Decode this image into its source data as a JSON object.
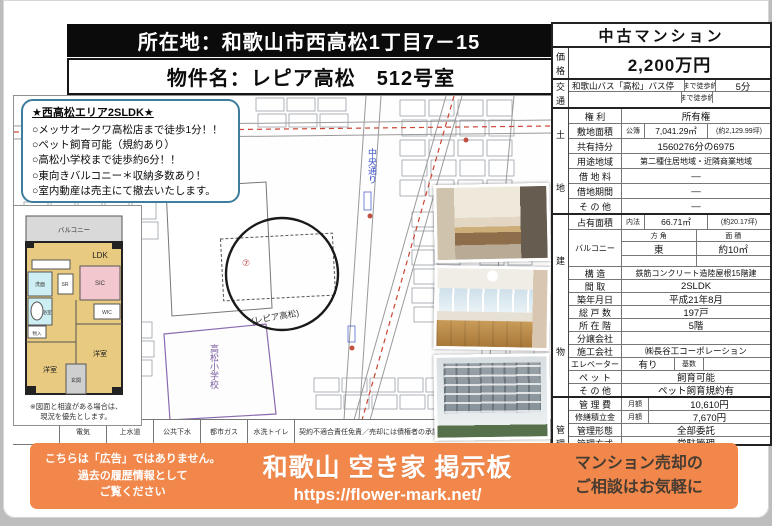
{
  "header": {
    "location_label": "所在地：",
    "location": "和歌山市西高松1丁目7－15",
    "name_label": "物件名：",
    "name": "レピア高松　512号室"
  },
  "highlights": {
    "title": "★西高松エリア2SLDK★",
    "items": [
      "○メッサオークワ高松店まで徒歩1分！！",
      "○ペット飼育可能（規約あり）",
      "○高松小学校まで徒歩約6分！！",
      "○東向きバルコニー＊収納多数あり！",
      "○室内動産は売主にて撤去いたします。"
    ]
  },
  "map": {
    "property": "(レピア高松)",
    "marker": "⑦",
    "road": "中央通り",
    "school": "高松小学校"
  },
  "floorplan": {
    "balcony": "バルコニー",
    "ldk": "LDK",
    "sr": "SR",
    "sic": "SIC",
    "wic": "WIC",
    "wash": "洗面",
    "bath": "浴室",
    "closet": "物入",
    "west_room": "洋室",
    "east_room": "洋室",
    "entrance": "玄関",
    "note1": "※図面と相違がある場合は、",
    "note2": "現況を優先とします。"
  },
  "utilities": {
    "cells": [
      "電気",
      "上水道",
      "公共下水",
      "都市ガス",
      "水洗トイレ"
    ],
    "note": "契約不適合責任免責／売却には債権者の承諾が必要です"
  },
  "panel": {
    "title": "中古マンション",
    "sections": [
      {
        "spine": "価格",
        "rows": [
          {
            "h": 30,
            "cells": [
              {
                "t": "2,200万円",
                "c": "price"
              }
            ]
          }
        ]
      },
      {
        "spine": "交通",
        "rows": [
          {
            "h": 11,
            "cells": [
              {
                "t": "和歌山バス「高松」バス停",
                "c": "sm left",
                "w": 112
              },
              {
                "t": "まで徒歩約",
                "c": "tiny",
                "w": 30
              },
              {
                "t": "5分"
              }
            ]
          },
          {
            "h": 11,
            "cells": [
              {
                "t": "",
                "w": 112
              },
              {
                "t": "まで徒歩約",
                "c": "tiny",
                "w": 30
              },
              {
                "t": ""
              }
            ]
          }
        ]
      },
      {
        "spine": "土地",
        "spread": true,
        "rows": [
          {
            "h": 14,
            "label": "権 利",
            "cells": [
              {
                "t": "所有権"
              }
            ]
          },
          {
            "h": 14,
            "label": "敷地面積",
            "cells": [
              {
                "t": "公簿",
                "c": "tiny",
                "w": 22
              },
              {
                "t": "7,041.29㎡",
                "c": "sm",
                "w": 62
              },
              {
                "t": "(約2,129.99坪)",
                "c": "tiny"
              }
            ]
          },
          {
            "h": 14,
            "label": "共有持分",
            "cells": [
              {
                "t": "1560276分の6975"
              }
            ]
          },
          {
            "h": 14,
            "label": "用途地域",
            "cells": [
              {
                "t": "第二種住居地域・近隣商業地域",
                "c": "xs"
              }
            ]
          },
          {
            "h": 14,
            "label": "借 地 料",
            "cells": [
              {
                "t": "―"
              }
            ]
          },
          {
            "h": 14,
            "label": "借地期間",
            "cells": [
              {
                "t": "―"
              }
            ]
          },
          {
            "h": 14,
            "label": "そ の 他",
            "cells": [
              {
                "t": "―"
              }
            ]
          }
        ]
      },
      {
        "spine": "建物",
        "spread": true,
        "rows": [
          {
            "h": 14,
            "label": "占有面積",
            "cells": [
              {
                "t": "内法",
                "c": "tiny",
                "w": 22
              },
              {
                "t": "66.71㎡",
                "c": "sm",
                "w": 62
              },
              {
                "t": "(約20.17坪)",
                "c": "tiny"
              }
            ]
          },
          {
            "label": "バルコニー",
            "lblc": "xs",
            "sub": [
              {
                "h": 11,
                "cells": [
                  {
                    "t": "方 角",
                    "c": "tiny"
                  },
                  {
                    "t": "面 積",
                    "c": "tiny"
                  }
                ]
              },
              {
                "h": 13,
                "cells": [
                  {
                    "t": "東"
                  },
                  {
                    "t": "約10㎡"
                  }
                ]
              },
              {
                "h": 10,
                "cells": [
                  {
                    "t": ""
                  },
                  {
                    "t": ""
                  }
                ]
              }
            ]
          },
          {
            "h": 12,
            "label": "構 造",
            "cells": [
              {
                "t": "鉄筋コンクリート造陸屋根15階建",
                "c": "xs"
              }
            ]
          },
          {
            "h": 12,
            "label": "間 取",
            "cells": [
              {
                "t": "2SLDK"
              }
            ]
          },
          {
            "h": 12,
            "label": "築年月日",
            "cells": [
              {
                "t": "平成21年8月"
              }
            ]
          },
          {
            "h": 12,
            "label": "総 戸 数",
            "cells": [
              {
                "t": "197戸"
              }
            ]
          },
          {
            "h": 12,
            "label": "所 在 階",
            "cells": [
              {
                "t": "5階"
              }
            ]
          },
          {
            "h": 12,
            "label": "分譲会社",
            "cells": [
              {
                "t": ""
              }
            ]
          },
          {
            "h": 12,
            "label": "施工会社",
            "cells": [
              {
                "t": "㈱長谷工コーポレーション",
                "c": "sm"
              }
            ]
          },
          {
            "h": 12,
            "label": "エレベーター",
            "lblc": "xs",
            "cells": [
              {
                "t": "有り",
                "w": 52
              },
              {
                "t": "基数",
                "c": "tiny",
                "w": 28
              },
              {
                "t": ""
              }
            ]
          },
          {
            "h": 12,
            "label": "ペ ッ ト",
            "cells": [
              {
                "t": "飼育可能"
              }
            ]
          },
          {
            "h": 12,
            "label": "そ の 他",
            "cells": [
              {
                "t": "ペット飼育規約有"
              }
            ]
          }
        ]
      },
      {
        "spine": "管理",
        "rows": [
          {
            "h": 12,
            "label": "管 理 費",
            "cells": [
              {
                "t": "月額",
                "c": "tiny",
                "w": 26
              },
              {
                "t": "10,610円"
              }
            ]
          },
          {
            "h": 12,
            "label": "修繕積立金",
            "lblc": "xs",
            "cells": [
              {
                "t": "月額",
                "c": "tiny",
                "w": 26
              },
              {
                "t": "7,670円"
              }
            ]
          },
          {
            "h": 12,
            "label": "管理形態",
            "cells": [
              {
                "t": "全部委託"
              }
            ]
          },
          {
            "h": 12,
            "label": "管理方式",
            "cells": [
              {
                "t": "常駐管理"
              }
            ]
          },
          {
            "h": 12,
            "label": "管理会社",
            "cells": [
              {
                "t": "関電コミュニティ株式会社",
                "c": "sm"
              }
            ]
          },
          {
            "h": 12,
            "label": "管理組合",
            "cells": [
              {
                "t": "有り",
                "c": "sm left",
                "w": 44
              },
              {
                "t": ""
              }
            ]
          }
        ]
      },
      {
        "spine": "",
        "rows": [
          {
            "label": "駐 車 場",
            "sub": [
              {
                "h": 12,
                "cells": [
                  {
                    "t": "有り"
                  }
                ]
              },
              {
                "h": 12,
                "cells": [
                  {
                    "t": "月額",
                    "c": "tiny",
                    "w": 26
                  },
                  {
                    "t": "3,500円"
                  }
                ]
              }
            ]
          }
        ]
      }
    ]
  },
  "banner": {
    "disclaimer": [
      "こちらは「広告」ではありません。",
      "過去の履歴情報として",
      "ご覧ください"
    ],
    "title": "和歌山 空き家 掲示板",
    "url": "https://flower-mark.net/",
    "cta1": "マンション売却の",
    "cta2": "ご相談はお気軽に",
    "orange": "#f1874b"
  }
}
